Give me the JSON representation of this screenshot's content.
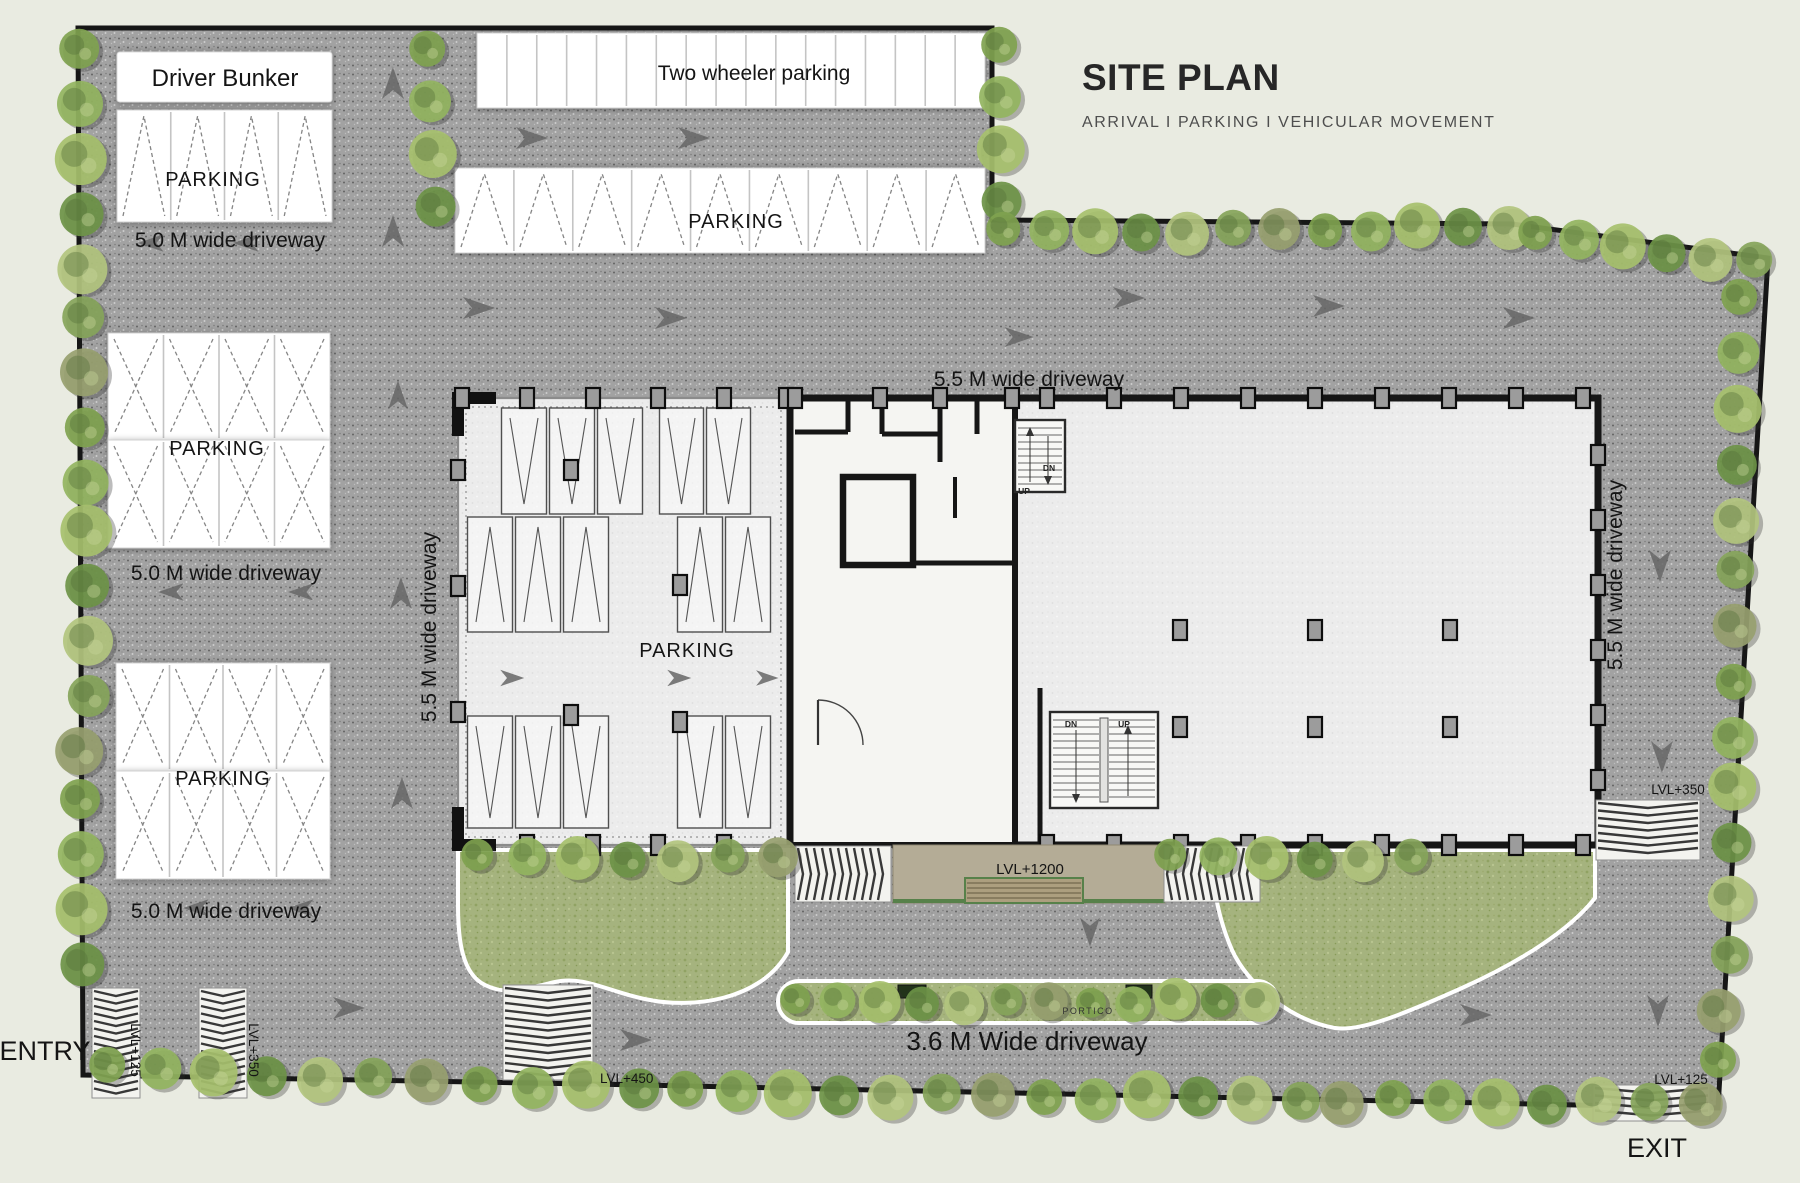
{
  "header": {
    "title": "SITE PLAN",
    "subtitle": "ARRIVAL I PARKING I VEHICULAR MOVEMENT"
  },
  "labels": {
    "driver_bunker": "Driver Bunker",
    "two_wheeler_parking": "Two wheeler parking",
    "parking": "PARKING",
    "driveway_5_0": "5.0 M wide driveway",
    "driveway_5_5": "5.5 M wide driveway",
    "driveway_3_6": "3.6 M Wide driveway",
    "entry": "ENTRY",
    "exit": "EXIT",
    "portico": "PORTICO",
    "stair_up": "UP",
    "stair_down": "DN",
    "lvl_125": "LVL+125",
    "lvl_350": "LVL+350",
    "lvl_450": "LVL+450",
    "lvl_1200": "LVL+1200"
  },
  "colors": {
    "paper": "#e9ebe1",
    "asphalt": "#a2a2a2",
    "building_floor": "#ececec",
    "wall": "#161616",
    "lawn": "#a5b37e",
    "portico_tan": "#b4ac96",
    "tree_green": "#86a855",
    "stall_white": "#ffffff",
    "arrow_gray": "#666666"
  }
}
